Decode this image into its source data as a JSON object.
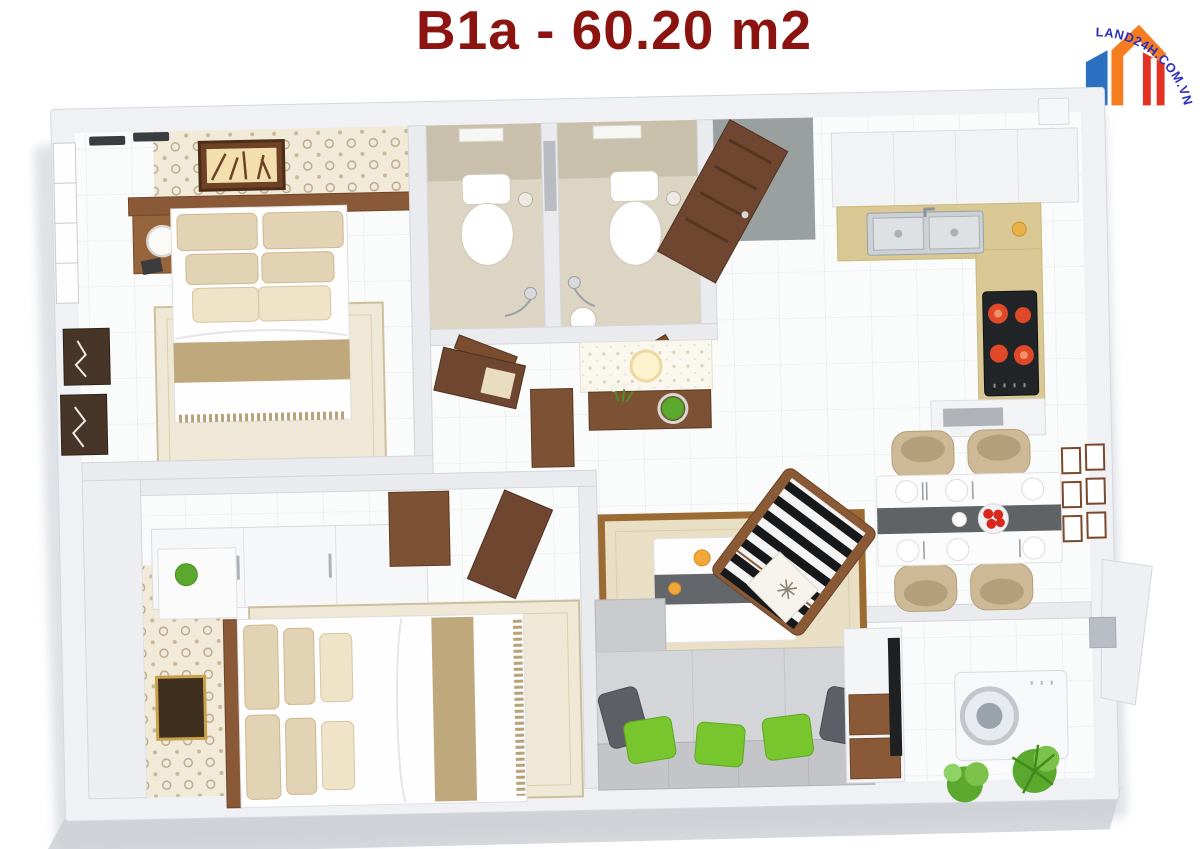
{
  "header": {
    "title": "B1a - 60.20 m2",
    "title_color": "#8b1410"
  },
  "logo": {
    "text": "LAND24H.COM.VN",
    "text_color": "#2a2ec0",
    "building_colors": {
      "blue": "#2a6fc0",
      "orange": "#f57d1f",
      "red": "#e43124"
    }
  },
  "palette": {
    "outer_wall": "#f0f1f4",
    "floor_tile": "#fafbfb",
    "wood_dark": "#6f4630",
    "wood_mid": "#8a5a38",
    "bath_tile": "#ddd5c4",
    "counter_gold": "#d9c893",
    "pillow_beige": "#e3d3b5",
    "throw_tan": "#bfa87c",
    "rug_living": "#e9dfc4",
    "rug_border_wood": "#9c6a33",
    "sofa_gray": "#d3d5d9",
    "pillow_green": "#78c62e",
    "pillow_dark": "#5c6066",
    "burner_red": "#e0482a",
    "fruit_red": "#d8281e",
    "plant_green": "#5aa82e",
    "stripe_black": "#17181a"
  }
}
